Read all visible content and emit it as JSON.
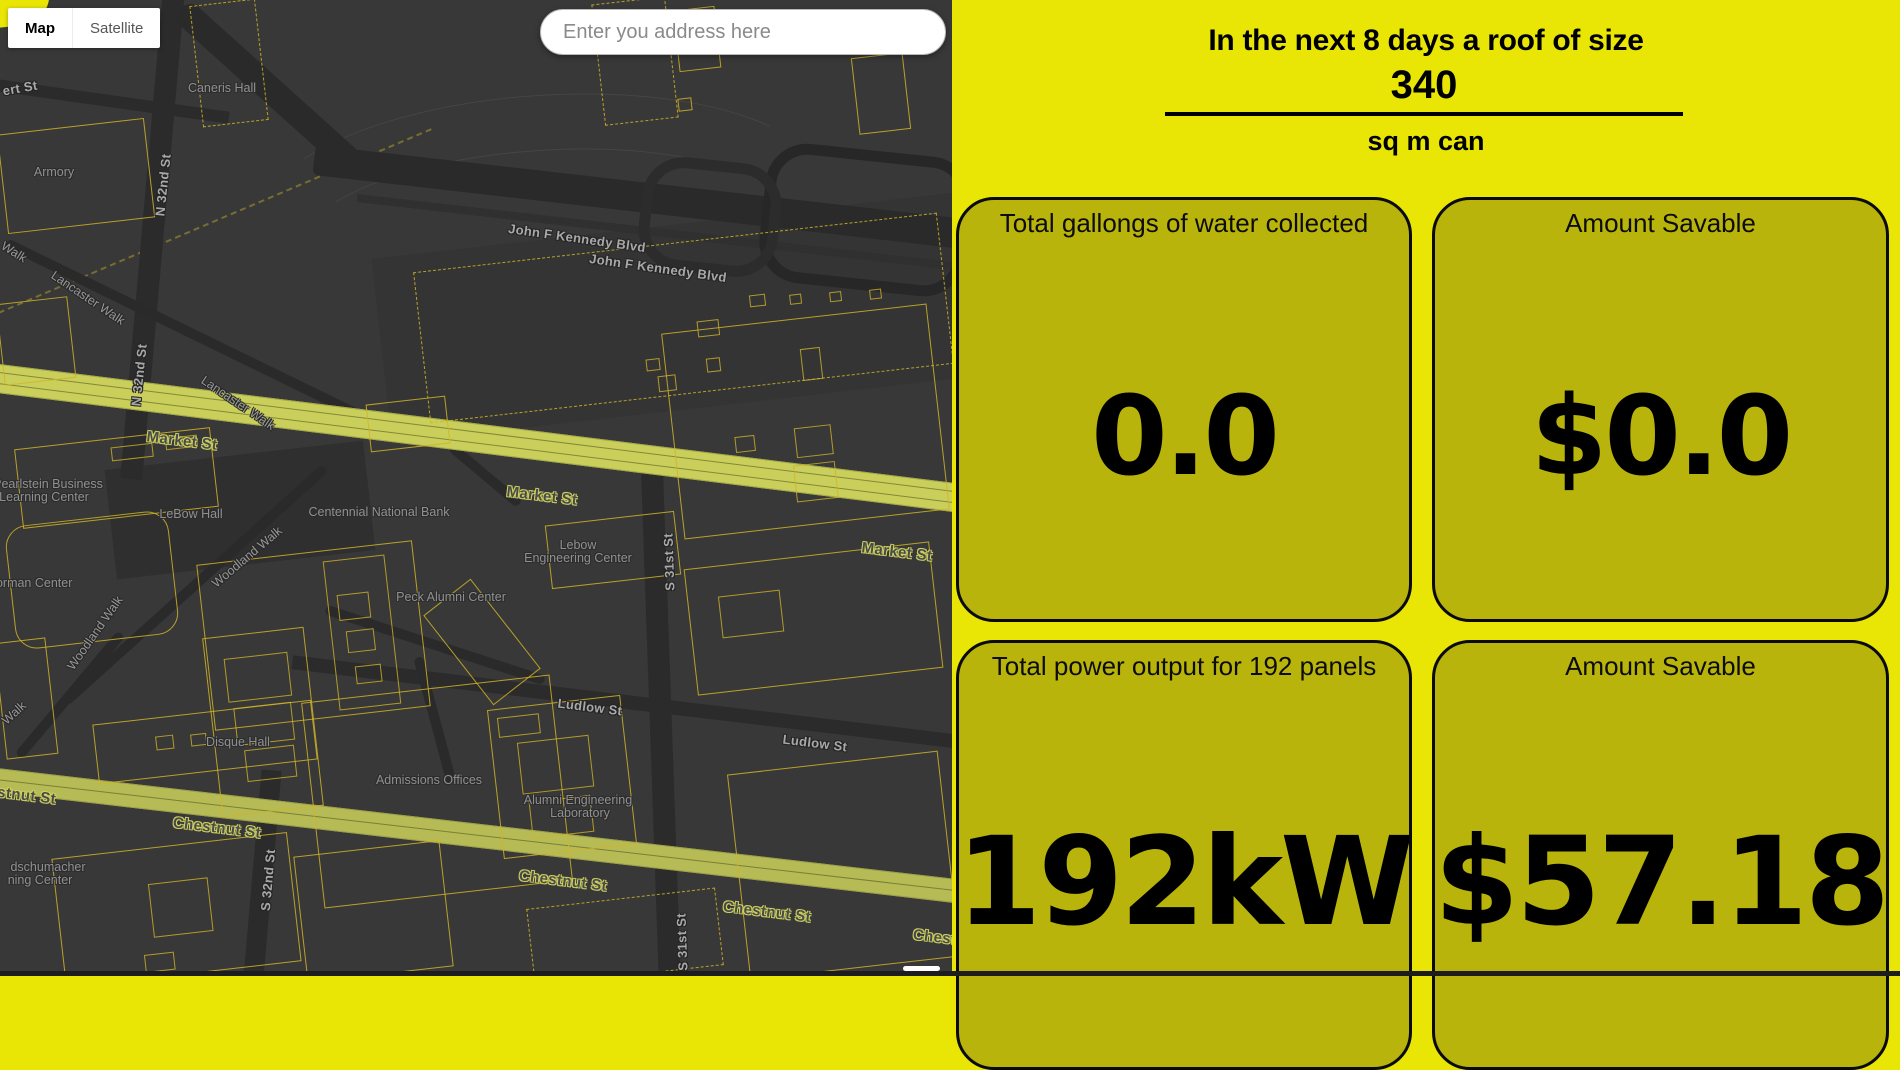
{
  "page": {
    "width": 1900,
    "height": 976
  },
  "map": {
    "type_control": {
      "map_label": "Map",
      "satellite_label": "Satellite"
    },
    "search": {
      "placeholder": "Enter you address here"
    },
    "labels": [
      {
        "text": "ert St",
        "x": 20,
        "y": 88,
        "r": -10,
        "type": "street"
      },
      {
        "text": "Caneris Hall",
        "x": 222,
        "y": 88,
        "r": 0,
        "type": "place"
      },
      {
        "text": "Armory",
        "x": 54,
        "y": 172,
        "r": 0,
        "type": "place"
      },
      {
        "text": "N 32nd St",
        "x": 163,
        "y": 185,
        "r": -84,
        "type": "street"
      },
      {
        "text": "John F Kennedy Blvd",
        "x": 577,
        "y": 238,
        "r": 8,
        "type": "street"
      },
      {
        "text": "John F Kennedy Blvd",
        "x": 658,
        "y": 268,
        "r": 8,
        "type": "street"
      },
      {
        "text": "Walk",
        "x": 14,
        "y": 252,
        "r": 32,
        "type": "walk"
      },
      {
        "text": "Lancaster Walk",
        "x": 88,
        "y": 298,
        "r": 34,
        "type": "walk"
      },
      {
        "text": "N 32nd St",
        "x": 139,
        "y": 375,
        "r": -84,
        "type": "street"
      },
      {
        "text": "Lancaster Walk",
        "x": 238,
        "y": 403,
        "r": 34,
        "type": "walk"
      },
      {
        "text": "Market St",
        "x": 182,
        "y": 441,
        "r": 7,
        "type": "major"
      },
      {
        "text": "Market St",
        "x": 542,
        "y": 496,
        "r": 7,
        "type": "major"
      },
      {
        "text": "Market St",
        "x": 897,
        "y": 552,
        "r": 7,
        "type": "major"
      },
      {
        "text": "Pearlstein Business",
        "x": 48,
        "y": 484,
        "r": 0,
        "type": "place"
      },
      {
        "text": "Learning Center",
        "x": 44,
        "y": 497,
        "r": 0,
        "type": "place"
      },
      {
        "text": "Centennial National Bank",
        "x": 379,
        "y": 512,
        "r": 0,
        "type": "place"
      },
      {
        "text": "LeBow Hall",
        "x": 191,
        "y": 514,
        "r": 0,
        "type": "place"
      },
      {
        "text": "Lebow",
        "x": 578,
        "y": 545,
        "r": 0,
        "type": "place"
      },
      {
        "text": "Engineering Center",
        "x": 578,
        "y": 558,
        "r": 0,
        "type": "place"
      },
      {
        "text": "Woodland Walk",
        "x": 247,
        "y": 557,
        "r": -40,
        "type": "walk"
      },
      {
        "text": "S 31st St",
        "x": 669,
        "y": 562,
        "r": -92,
        "type": "street"
      },
      {
        "text": "Korman Center",
        "x": 30,
        "y": 583,
        "r": 0,
        "type": "place"
      },
      {
        "text": "Peck Alumni Center",
        "x": 451,
        "y": 597,
        "r": 0,
        "type": "place"
      },
      {
        "text": "Woodland Walk",
        "x": 95,
        "y": 633,
        "r": -55,
        "type": "walk"
      },
      {
        "text": "Ludlow St",
        "x": 590,
        "y": 707,
        "r": 7,
        "type": "street"
      },
      {
        "text": "Walk",
        "x": 14,
        "y": 713,
        "r": -42,
        "type": "walk"
      },
      {
        "text": "Disque Hall",
        "x": 238,
        "y": 742,
        "r": 0,
        "type": "place"
      },
      {
        "text": "Ludlow St",
        "x": 815,
        "y": 743,
        "r": 7,
        "type": "street"
      },
      {
        "text": "Admissions Offices",
        "x": 429,
        "y": 780,
        "r": 0,
        "type": "place"
      },
      {
        "text": "Chestnut St",
        "x": 12,
        "y": 794,
        "r": 7,
        "type": "major"
      },
      {
        "text": "Alumni Engineering",
        "x": 578,
        "y": 800,
        "r": 0,
        "type": "place"
      },
      {
        "text": "Laboratory",
        "x": 580,
        "y": 813,
        "r": 0,
        "type": "place"
      },
      {
        "text": "Chestnut St",
        "x": 217,
        "y": 828,
        "r": 7,
        "type": "major"
      },
      {
        "text": "dschumacher",
        "x": 48,
        "y": 867,
        "r": 0,
        "type": "place"
      },
      {
        "text": "ning Center",
        "x": 40,
        "y": 880,
        "r": 0,
        "type": "place"
      },
      {
        "text": "S 32nd St",
        "x": 268,
        "y": 880,
        "r": -85,
        "type": "street"
      },
      {
        "text": "Chestnut St",
        "x": 563,
        "y": 881,
        "r": 7,
        "type": "major"
      },
      {
        "text": "Chestnut St",
        "x": 767,
        "y": 912,
        "r": 7,
        "type": "major"
      },
      {
        "text": "Chestnut St",
        "x": 957,
        "y": 940,
        "r": 7,
        "type": "major"
      },
      {
        "text": "S 31st St",
        "x": 682,
        "y": 942,
        "r": -92,
        "type": "street"
      }
    ]
  },
  "panel": {
    "header_line1": "In the next 8 days a roof of size",
    "roof_size": {
      "value": "340"
    },
    "header_line2": "sq m can",
    "cards": [
      {
        "title": "Total gallongs of water collected",
        "value": "0.0"
      },
      {
        "title": "Amount Savable",
        "value": "$0.0"
      },
      {
        "title": "Total power output for 192 panels",
        "value": "192kW"
      },
      {
        "title": "Amount Savable",
        "value": "$57.18"
      }
    ]
  },
  "colors": {
    "page_background": "#e9e606",
    "card_background": "#b9b40b",
    "map_background": "#383838",
    "market_st_fill": "#c9cf5a",
    "chestnut_st_fill": "#b6bb55",
    "building_outline": "#d1b428",
    "bottom_bar": "#1d1d1d"
  }
}
